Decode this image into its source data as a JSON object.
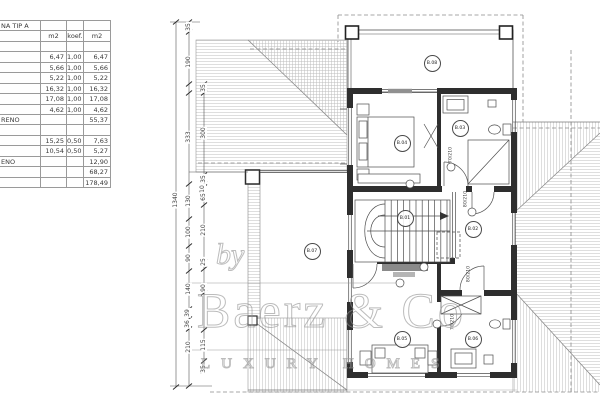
{
  "document_title": "floor plan sheet",
  "area_table": {
    "title_fragment": "NA TIP A",
    "columns": [
      "m2",
      "koef.",
      "m2"
    ],
    "rows": [
      [
        "NA TIP A",
        "",
        "",
        ""
      ],
      [
        "",
        "m2",
        "koef.",
        "m2"
      ],
      [
        "",
        "",
        "",
        ""
      ],
      [
        "",
        "6,47",
        "1,00",
        "6,47"
      ],
      [
        "",
        "5,66",
        "1,00",
        "5,66"
      ],
      [
        "",
        "5,22",
        "1,00",
        "5,22"
      ],
      [
        "",
        "16,32",
        "1,00",
        "16,32"
      ],
      [
        "",
        "17,08",
        "1,00",
        "17,08"
      ],
      [
        "",
        "4,62",
        "1,00",
        "4,62"
      ],
      [
        "RENO",
        "",
        "",
        "55,37"
      ],
      [
        "",
        "",
        "",
        ""
      ],
      [
        "",
        "15,25",
        "0,50",
        "7,63"
      ],
      [
        "",
        "10,54",
        "0,50",
        "5,27"
      ],
      [
        "ENO",
        "",
        "",
        "12,90"
      ],
      [
        "",
        "",
        "",
        "68,27"
      ],
      [
        "",
        "",
        "",
        "178,49"
      ]
    ]
  },
  "dimension_labels": [
    {
      "v": "1340",
      "x": 176,
      "y": 200
    },
    {
      "v": "35",
      "x": 189,
      "y": 27
    },
    {
      "v": "190",
      "x": 189,
      "y": 62
    },
    {
      "v": "333",
      "x": 189,
      "y": 137
    },
    {
      "v": "130",
      "x": 189,
      "y": 201
    },
    {
      "v": "100",
      "x": 189,
      "y": 232
    },
    {
      "v": "90",
      "x": 189,
      "y": 258
    },
    {
      "v": "140",
      "x": 189,
      "y": 289
    },
    {
      "v": "39",
      "x": 188,
      "y": 313
    },
    {
      "v": "36",
      "x": 188,
      "y": 324
    },
    {
      "v": "210",
      "x": 189,
      "y": 347
    },
    {
      "v": "35",
      "x": 204,
      "y": 88
    },
    {
      "v": "300",
      "x": 204,
      "y": 133
    },
    {
      "v": "35",
      "x": 204,
      "y": 179
    },
    {
      "v": "10",
      "x": 203,
      "y": 189
    },
    {
      "v": "65",
      "x": 204,
      "y": 197
    },
    {
      "v": "210",
      "x": 204,
      "y": 230
    },
    {
      "v": "25",
      "x": 204,
      "y": 262
    },
    {
      "v": "90",
      "x": 204,
      "y": 288
    },
    {
      "v": "115",
      "x": 204,
      "y": 345
    },
    {
      "v": "35",
      "x": 204,
      "y": 369
    }
  ],
  "rooms": [
    {
      "id": "B.01",
      "x": 404,
      "y": 217
    },
    {
      "id": "B.02",
      "x": 472,
      "y": 228
    },
    {
      "id": "B.03",
      "x": 459,
      "y": 127
    },
    {
      "id": "B.04",
      "x": 401,
      "y": 142
    },
    {
      "id": "B.05",
      "x": 401,
      "y": 338
    },
    {
      "id": "B.06",
      "x": 472,
      "y": 338
    },
    {
      "id": "B.07",
      "x": 311,
      "y": 250
    },
    {
      "id": "B.08",
      "x": 431,
      "y": 62
    }
  ],
  "door_sizes": [
    {
      "v": "70/210",
      "x": 452,
      "y": 155
    },
    {
      "v": "80/210",
      "x": 467,
      "y": 199
    },
    {
      "v": "80/210",
      "x": 470,
      "y": 274
    },
    {
      "v": "70/210",
      "x": 454,
      "y": 322
    }
  ],
  "watermark": {
    "by": "by",
    "name": "Baerz & Co",
    "tagline": "LUXURY HOMES"
  },
  "colors": {
    "wall": "#2e2e2e",
    "thin_line": "#4d4d4d",
    "hatch": "#bcbcbc",
    "dashed": "#8a8a8a",
    "watermark": "#949494"
  }
}
